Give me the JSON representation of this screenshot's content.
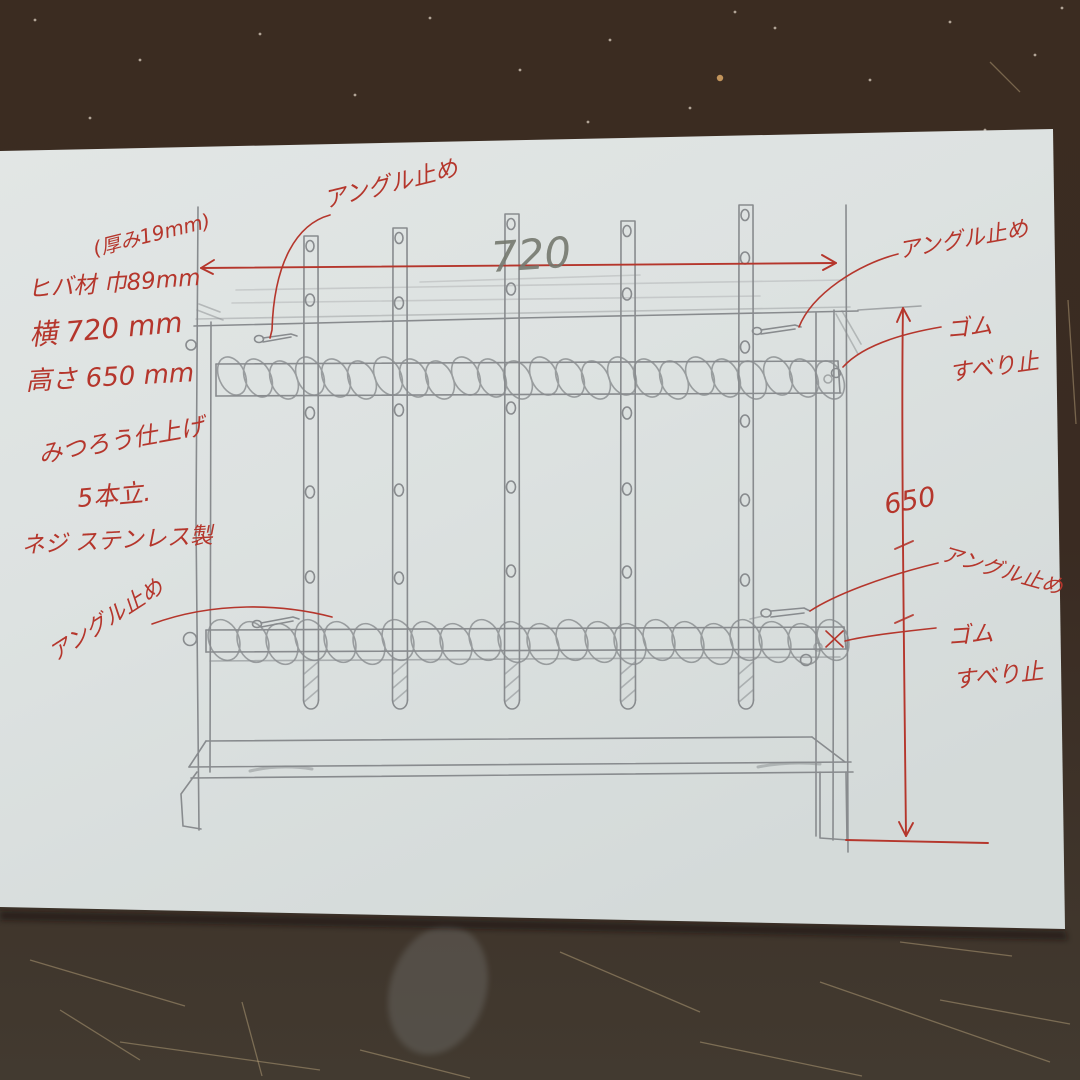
{
  "sketch": {
    "specs": [
      "(厚み19mm)",
      "ヒバ材 巾89mm",
      "横 720 mm",
      "高さ 650 mm",
      "みつろう仕上げ",
      "5本立.",
      "ネジ ステンレス製"
    ],
    "labels": {
      "angle_stop_top": "アングル止め",
      "angle_stop_top_right": "アングル止め",
      "angle_stop_mid_right": "アングル止め",
      "angle_stop_bottom_left": "アングル止め",
      "rubber_top_line1": "ゴム",
      "rubber_top_line2": "すべり止",
      "rubber_bottom_line1": "ゴム",
      "rubber_bottom_line2": "すべり止"
    },
    "dimensions": {
      "width": "720",
      "height": "650"
    },
    "colors": {
      "ink": "#b5362c",
      "pencil": "#84878a",
      "paper": "#dde2e1",
      "table": "#3a2b21"
    }
  }
}
